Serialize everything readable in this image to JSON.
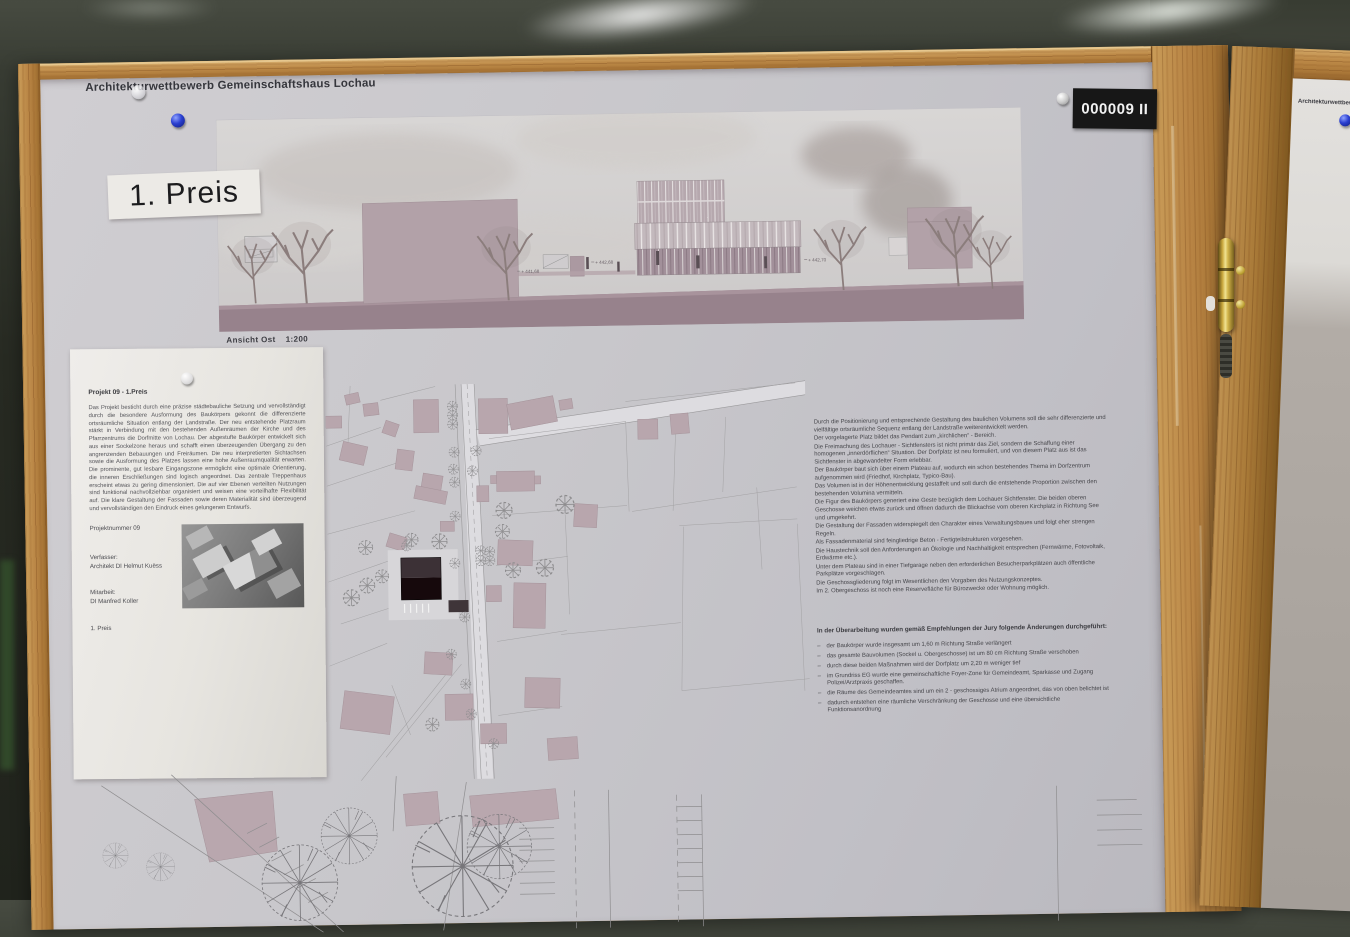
{
  "photo": {
    "board_title": "Architekturwettbewerb Gemeinschaftshaus Lochau",
    "prize_label": "1. Preis",
    "entry_badge": "000009 II",
    "board2_title_partial": "Architekturwettbewerb"
  },
  "elevation": {
    "caption_title": "Ansicht Ost",
    "caption_scale": "1:200",
    "levels": [
      "+ 441,68",
      "+ 442,68",
      "+ 442,70"
    ]
  },
  "jury_sheet": {
    "heading": "Projekt 09 - 1.Preis",
    "body": "Das Projekt besticht durch eine präzise städtebauliche Setzung und vervollständigt durch die besondere Ausformung des Baukörpers gekonnt die differenzierte ortsräumliche Situation entlang der Landstraße. Der neu entstehende Platzraum stärkt in Verbindung mit den bestehenden Außenräumen der Kirche und des Pfarrzentrums die Dorfmitte von Lochau. Der abgestufte Baukörper entwickelt sich aus einer Sockelzone heraus und schafft einen überzeugenden Übergang zu den angrenzenden Bebauungen und Freiräumen. Die neu interpretierten Sichtachsen sowie die Ausformung des Platzes lassen eine hohe Außenraumqualität erwarten. Die prominente, gut lesbare Eingangszone ermöglicht eine optimale Orientierung, die inneren Erschließungen sind logisch angeordnet. Das zentrale Treppenhaus erscheint etwas zu gering dimensioniert. Die auf vier Ebenen verteilten Nutzungen sind funktional nachvollziehbar organisiert und weisen eine vorteilhafte Flexibilität auf. Die klare Gestaltung der Fassaden sowie deren Materialität sind überzeugend und vervollständigen den Eindruck eines gelungenen Entwurfs.",
    "project_number": "Projektnummer 09",
    "author_label": "Verfasser:",
    "author": "Architekt DI Helmut Kuëss",
    "collaborator_label": "Mitarbeit:",
    "collaborator": "DI Manfred Koller",
    "prize": "1. Preis"
  },
  "description": {
    "paragraphs": [
      "Durch die Positionierung und entsprechende Gestaltung des baulichen Volumens soll die sehr differenzierte und vielfältige ortsräumliche Sequenz entlang der Landstraße weiterentwickelt werden.",
      "Der vorgelagerte Platz bildet das Pendant zum „kirchlichen“ - Bereich.",
      "Die Freimachung des Lochauer - Sichtfensters ist nicht primär das Ziel, sondern die Schaffung einer homogenen „innerdörflichen“ Situation. Der Dorfplatz ist neu formuliert, und von diesem Platz aus ist das Sichtfenster in abgewandelter Form erlebbar.",
      "Der Baukörper baut sich über einem Plateau auf, wodurch ein schon bestehendes Thema im Dorfzentrum aufgenommen wird (Friedhof, Kirchplatz, Typico-Bau).",
      "Das Volumen ist in der Höhenentwicklung gestaffelt und soll durch die entstehende Proportion zwischen den bestehenden Volumina vermitteln.",
      "Die Figur des Baukörpers generiert eine Geste bezüglich dem Lochauer Sichtfenster. Die beiden oberen Geschosse weichen etwas zurück und öffnen dadurch die Blickachse vom oberen Kirchplatz in Richtung See und umgekehrt.",
      "Die Gestaltung der Fassaden widerspiegelt den Charakter eines Verwaltungsbaues und folgt eher strengen Regeln.",
      "Als Fassadenmaterial sind feingliedrige Beton - Fertigteilstrukturen vorgesehen.",
      "Die Haustechnik soll den Anforderungen an Ökologie und Nachhaltigkeit entsprechen (Fernwärme, Fotovoltaik, Erdwärme etc.).",
      "Unter dem Plateau sind in einer Tiefgarage neben den erforderlichen Besucherparkplätzen auch öffentliche Parkplätze vorgeschlagen.",
      "Die Geschossgliederung folgt im Wesentlichen den Vorgaben des Nutzungskonzeptes.",
      "Im 2. Obergeschoss ist noch eine Reservefläche für Bürozwecke oder Wohnung möglich."
    ]
  },
  "revisions": {
    "heading": "In der Überarbeitung wurden gemäß Empfehlungen der Jury folgende Änderungen durchgeführt:",
    "items": [
      "der Baukörper wurde insgesamt um 1,60 m Richtung Straße verlängert",
      "das gesamte Bauvolumen (Sockel u. Obergeschosse) ist um 80 cm Richtung Straße verschoben",
      "durch diese beiden Maßnahmen wird der Dorfplatz um 2,20 m weniger tief",
      "im Grundriss EG wurde eine gemeinschaftliche Foyer-Zone für Gemeindeamt, Sparkasse und Zugang Polizei/Arztpraxis geschaffen.",
      "die Räume des Gemeindeamtes sind um ein 2 - geschossiges Atrium angeordnet, das von oben belichtet ist",
      "dadurch entstehen eine räumliche Verschränkung der Geschosse und eine übersichtliche Funktionsanordnung"
    ]
  },
  "colors": {
    "wood": "#b5813f",
    "poster": "#c8c7cb",
    "plan_building_fill": "#b8a6ad",
    "pin_blue": "#2a3fd0",
    "badge_bg": "#171717",
    "grass": "#5c8a42"
  }
}
